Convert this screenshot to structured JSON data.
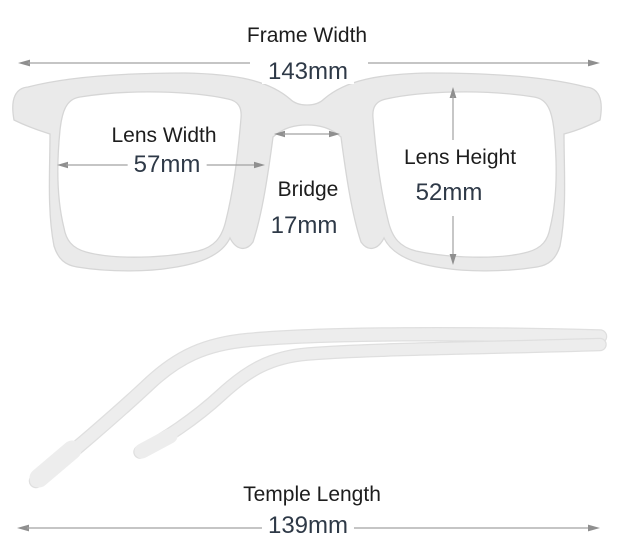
{
  "measurements": {
    "frame_width": {
      "label": "Frame Width",
      "value": "143mm"
    },
    "lens_width": {
      "label": "Lens Width",
      "value": "57mm"
    },
    "bridge": {
      "label": "Bridge",
      "value": "17mm"
    },
    "lens_height": {
      "label": "Lens Height",
      "value": "52mm"
    },
    "temple_length": {
      "label": "Temple Length",
      "value": "139mm"
    }
  },
  "colors": {
    "background": "#ffffff",
    "frame_fill": "#eaeaea",
    "frame_edge": "#d6d6d6",
    "arrow": "#9b9b9b",
    "label_text": "#1d1d1d",
    "value_text": "#2e3947"
  }
}
